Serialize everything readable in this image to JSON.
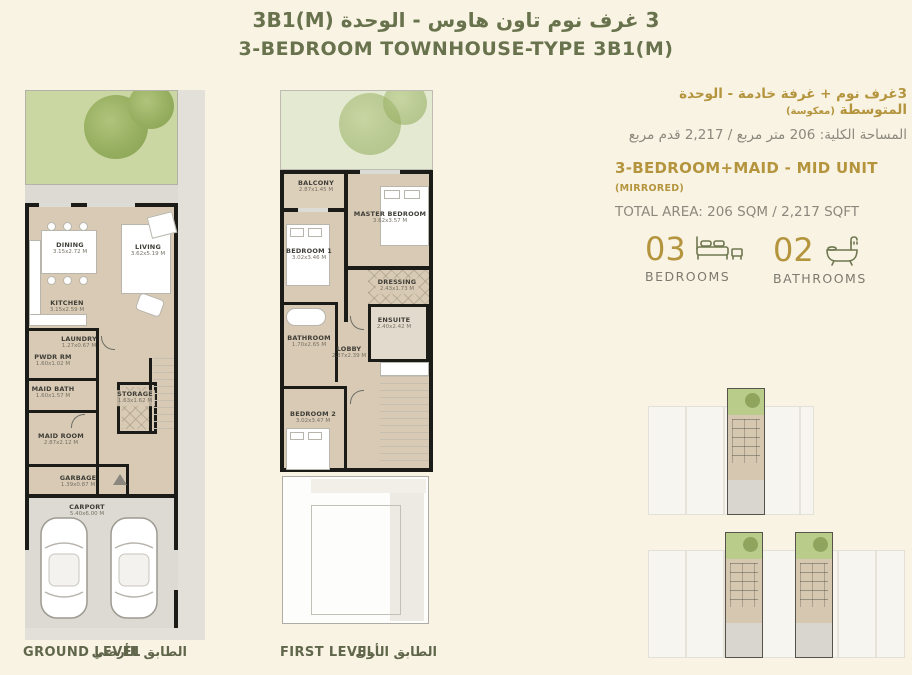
{
  "header": {
    "title_ar": "3 غرف نوم تاون هاوس - الوحدة  3B1(M)",
    "title_en": "3-BEDROOM TOWNHOUSE-TYPE 3B1(M)"
  },
  "unit_info": {
    "type_ar": "3غرف نوم + غرفة خادمة - الوحدة المتوسطة",
    "type_ar_note": "(معكوسة)",
    "area_ar": "المساحة الكلية: 206 متر مربع / 2,217 قدم مربع",
    "type_en": "3-BEDROOM+MAID - MID UNIT",
    "type_en_note": "(MIRRORED)",
    "area_en": "TOTAL AREA: 206 SQM / 2,217 SQFT"
  },
  "stats": {
    "bedrooms": {
      "value": "03",
      "label": "BEDROOMS"
    },
    "bathrooms": {
      "value": "02",
      "label": "BATHROOMS"
    }
  },
  "ground_level": {
    "label_en": "GROUND LEVEL",
    "label_ar": "الطابق الأرضي",
    "rooms": {
      "dining": {
        "name": "DINING",
        "dim": "3.15x2.72 M"
      },
      "living": {
        "name": "LIVING",
        "dim": "3.62x5.19 M"
      },
      "kitchen": {
        "name": "KITCHEN",
        "dim": "3.15x2.59 M"
      },
      "laundry": {
        "name": "LAUNDRY",
        "dim": "1.27x0.67 M"
      },
      "pwdr": {
        "name": "PWDR RM",
        "dim": "1.60x1.02 M"
      },
      "maidbath": {
        "name": "MAID BATH",
        "dim": "1.60x1.57 M"
      },
      "storage": {
        "name": "STORAGE",
        "dim": "1.63x1.62 M"
      },
      "maidroom": {
        "name": "MAID ROOM",
        "dim": "2.87x2.12 M"
      },
      "garbage": {
        "name": "GARBAGE",
        "dim": "1.39x0.87 M"
      },
      "carport": {
        "name": "CARPORT",
        "dim": "5.40x6.00 M"
      }
    }
  },
  "first_level": {
    "label_en": "FIRST LEVEL",
    "label_ar": "الطابق الأول",
    "rooms": {
      "balcony": {
        "name": "BALCONY",
        "dim": "2.87x1.45 M"
      },
      "master": {
        "name": "MASTER BEDROOM",
        "dim": "3.62x3.57 M"
      },
      "bedroom1": {
        "name": "BEDROOM 1",
        "dim": "3.02x3.46 M"
      },
      "dressing": {
        "name": "DRESSING",
        "dim": "2.43x1.73 M"
      },
      "ensuite": {
        "name": "ENSUITE",
        "dim": "2.40x2.42 M"
      },
      "bathroom": {
        "name": "BATHROOM",
        "dim": "1.70x2.65 M"
      },
      "lobby": {
        "name": "LOBBY",
        "dim": "2.37x2.39 M"
      },
      "bedroom2": {
        "name": "BEDROOM 2",
        "dim": "3.02x3.47 M"
      }
    }
  },
  "colors": {
    "accent_gold": "#b4953e",
    "accent_olive": "#68724c",
    "floor_beige": "#d8cab4",
    "garden_green": "#ccd7a0",
    "wall_black": "#1b1b18"
  }
}
